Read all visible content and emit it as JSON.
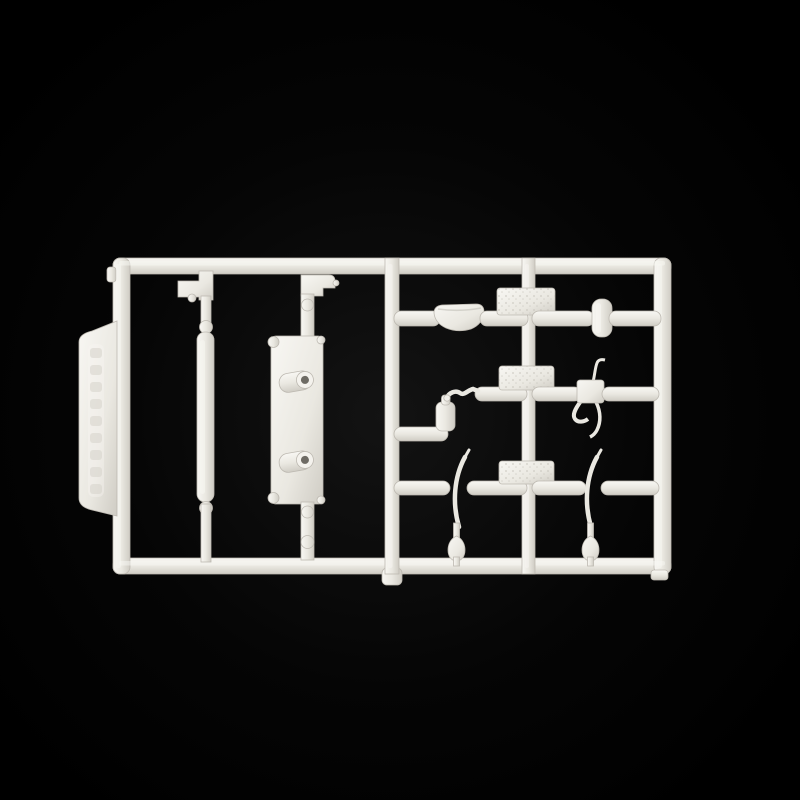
{
  "scene": {
    "description": "Photograph of a white injection-moulded plastic model kit sprue (rectangular parts runner) centred on a plain black background. The left half holds a long rod part and a rectangular side plate with two round bosses; the right half is a grid of three horizontal runners carrying a shallow dish, a small roller disc, a lever block with bent arms, a small canister with a curved hose, and two thin curved blade parts with teardrop knobs. A flat tab with illegible embossed vertical lettering protrudes from the left rail.",
    "tab_note": "embossed vertical manufacturer lettering, not legible"
  },
  "colors": {
    "background_center": "#131313",
    "background": "#050505",
    "background_edge": "#000000",
    "plastic_light": "#f8f7f3",
    "plastic_base": "#eae8e1",
    "plastic_dark": "#cfccc4",
    "plastic_edge": "#bdb9b1",
    "hole": "#6e6b64",
    "texture_dot": "#c6c3bb",
    "emboss_mark": "#d6d3cb"
  },
  "parts": {
    "frame": {
      "label": "rectangular runner frame"
    },
    "tab": {
      "label": "embossed label tab (lettering illegible)"
    },
    "step_bracket": {
      "label": "small stepped bracket part"
    },
    "long_rod": {
      "label": "long cylindrical rod part"
    },
    "notched_bracket": {
      "label": "notched bracket part"
    },
    "side_plate": {
      "label": "rectangular side plate with two round bosses"
    },
    "curved_dish": {
      "label": "shallow curved dish part"
    },
    "roller_disc": {
      "label": "small roller disc part"
    },
    "lever_block": {
      "label": "lever block with bent control arms"
    },
    "canister": {
      "label": "small canister with curved hose"
    },
    "blade_left": {
      "label": "thin curved blade part, left"
    },
    "blade_right": {
      "label": "thin curved blade part, right"
    },
    "knob_left": {
      "label": "teardrop knob, left"
    },
    "knob_right": {
      "label": "teardrop knob, right"
    },
    "junction_pad": {
      "label": "textured junction pad"
    },
    "gate": {
      "label": "moulding gate bulge"
    }
  }
}
